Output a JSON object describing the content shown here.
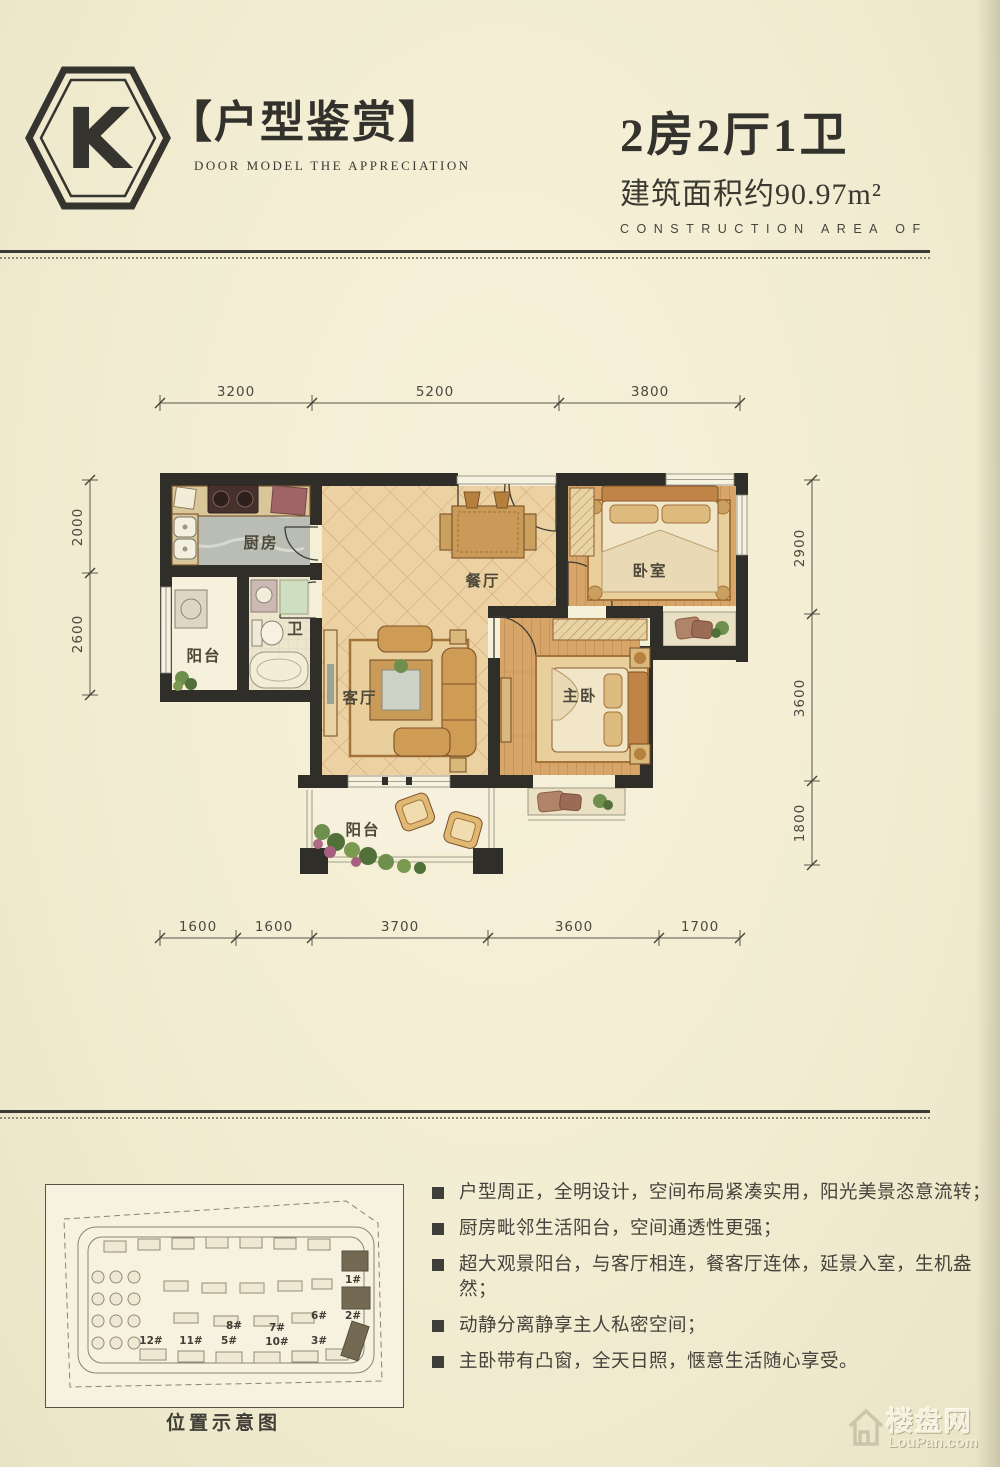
{
  "header": {
    "logo_letter": "K",
    "series_title": "【户型鉴赏】",
    "series_subtitle": "DOOR MODEL THE APPRECIATION",
    "unit_type": "2房2厅1卫",
    "area": "建筑面积约90.97m²",
    "area_caption": "CONSTRUCTION AREA OF"
  },
  "plan": {
    "rooms": {
      "kitchen": "厨房",
      "bath": "卫",
      "balcony_side": "阳台",
      "dining": "餐厅",
      "living": "客厅",
      "bedroom": "卧室",
      "master": "主卧",
      "balcony_bottom": "阳台"
    },
    "dims": {
      "top": [
        "3200",
        "5200",
        "3800"
      ],
      "bottom": [
        "1600",
        "1600",
        "3700",
        "3600",
        "1700"
      ],
      "left": [
        "2000",
        "2600"
      ],
      "right": [
        "2900",
        "3600",
        "1800"
      ]
    }
  },
  "features": {
    "items": [
      "户型周正，全明设计，空间布局紧凑实用，阳光美景恣意流转；",
      "厨房毗邻生活阳台，空间通透性更强；",
      "超大观景阳台，与客厅相连，餐客厅连体，延景入室，生机盎然；",
      "动静分离静享主人私密空间；",
      "主卧带有凸窗，全天日照，惬意生活随心享受。"
    ]
  },
  "sitemap": {
    "caption": "位置示意图",
    "buildings": [
      "1#",
      "2#",
      "6#",
      "8#",
      "7#",
      "12#",
      "11#",
      "5#",
      "10#",
      "3#"
    ]
  },
  "watermark": {
    "brand": "楼盘网",
    "domain": "LouPan.com"
  },
  "colors": {
    "paper": "#f2edd2",
    "ink": "#34332d",
    "wall": "#2f2e29",
    "tile_floor": "#ecd2a2",
    "wood_floor": "#d7a568"
  }
}
